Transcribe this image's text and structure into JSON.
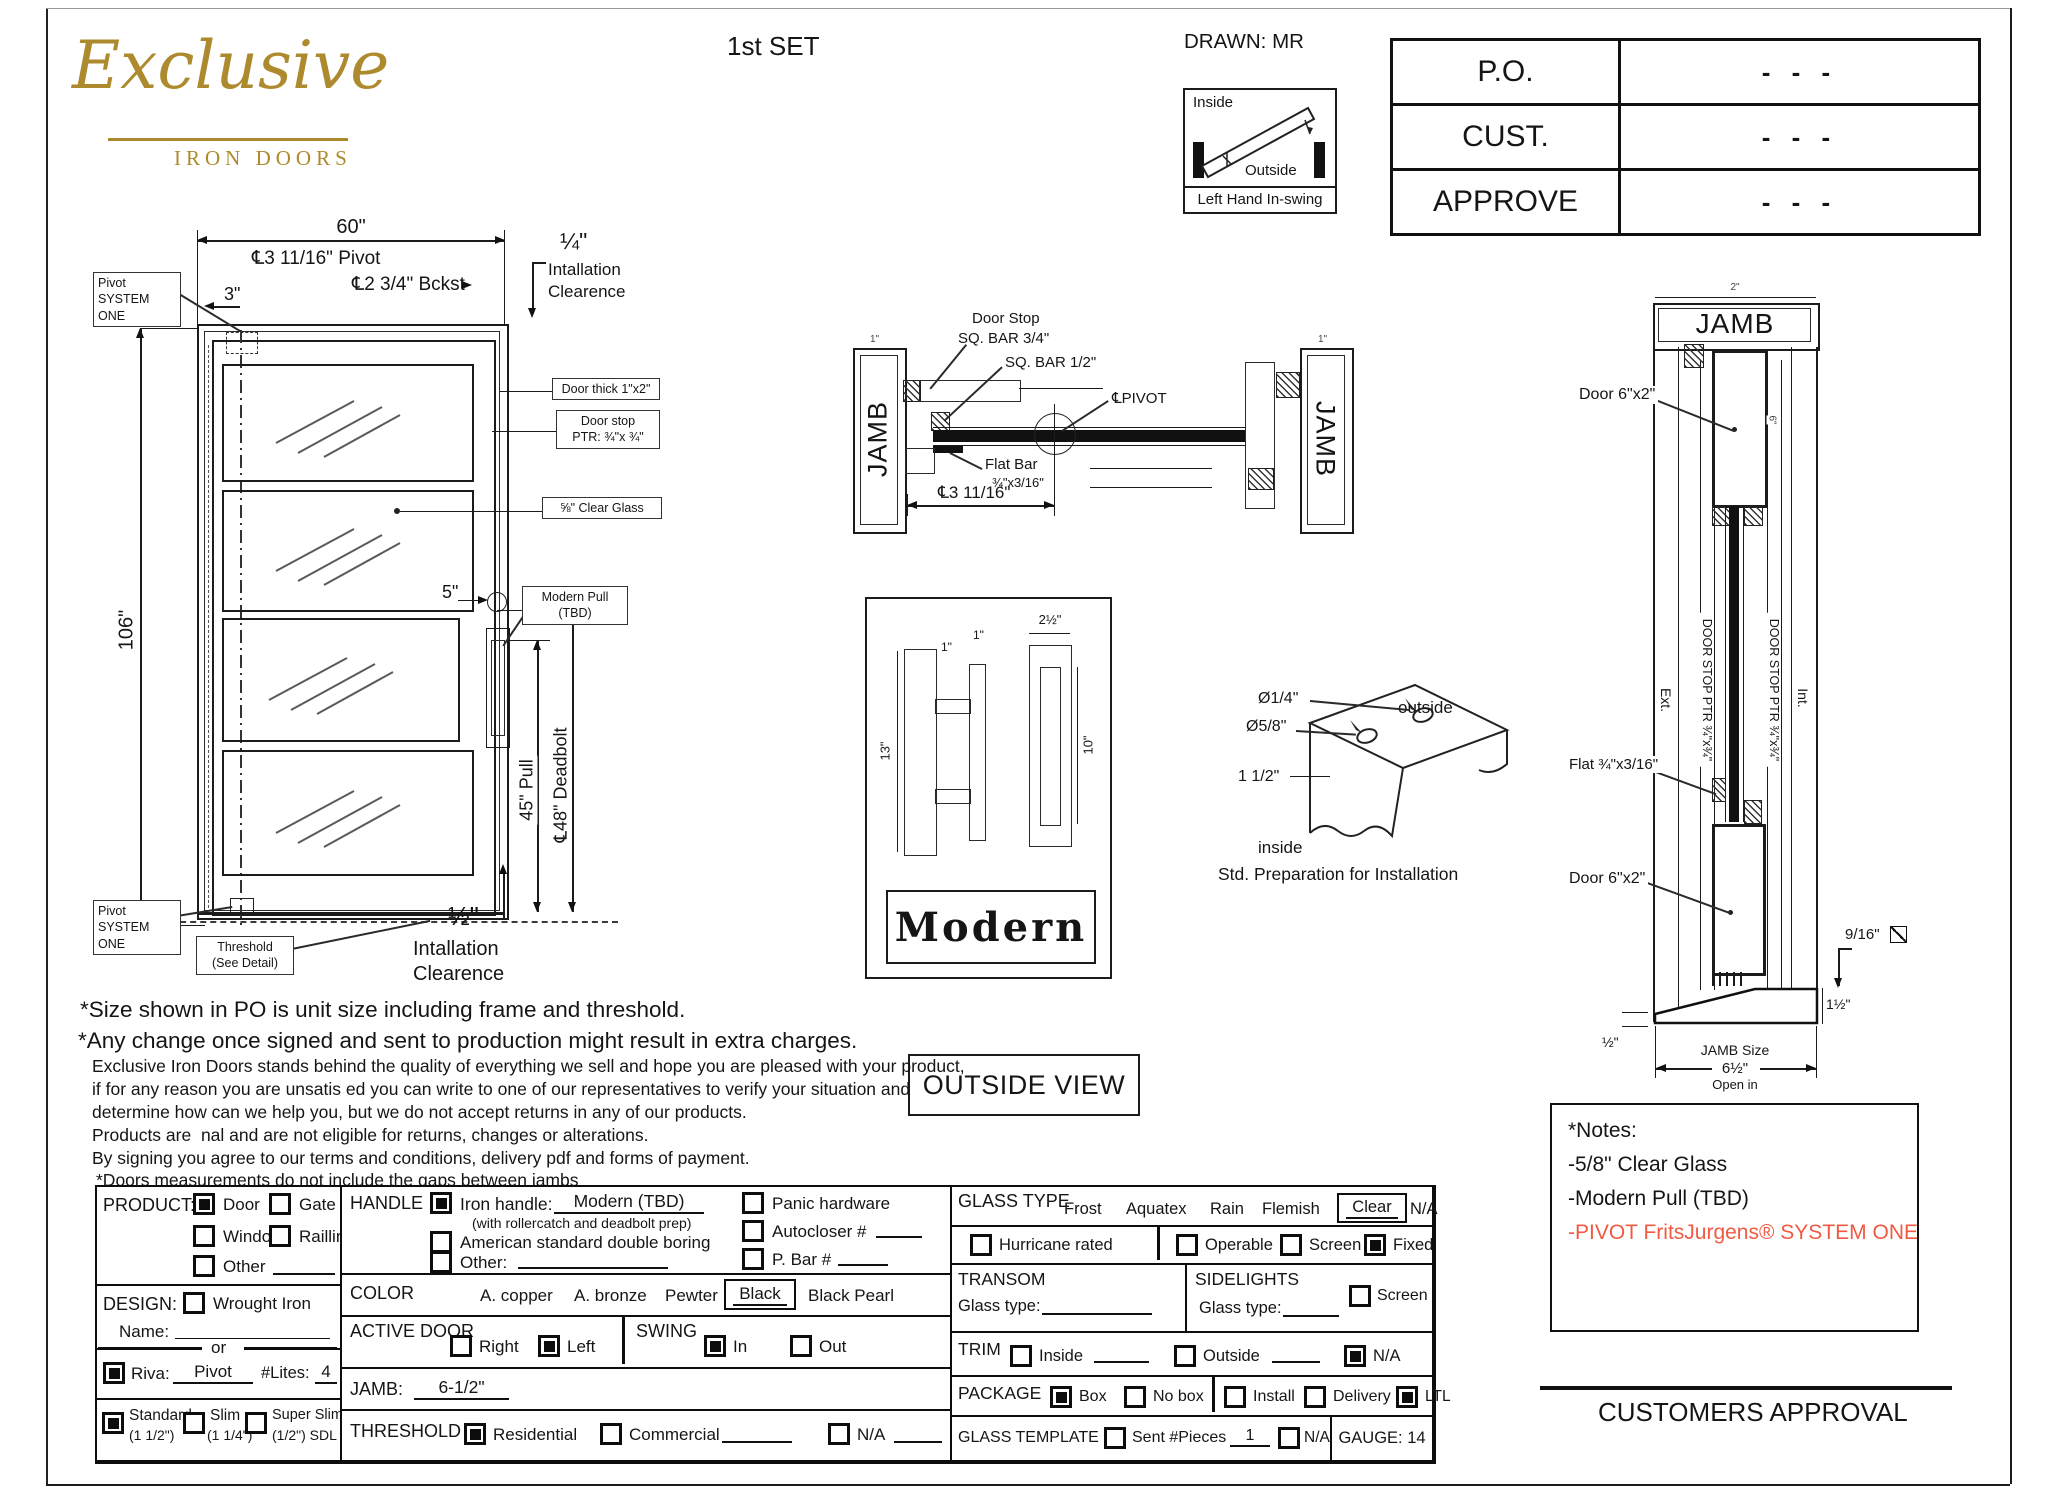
{
  "colors": {
    "gold": "#AD8A2D",
    "accent_orange": "#F05A43",
    "line": "#1C1C1C"
  },
  "header": {
    "set_label": "1st SET",
    "drawn_label": "DRAWN: MR",
    "logo_name": "Exclusive",
    "logo_sub": "IRON DOORS",
    "swing": {
      "inside": "Inside",
      "outside": "Outside",
      "caption": "Left Hand In-swing"
    },
    "approval_table": {
      "rows": [
        {
          "label": "P.O.",
          "value": "- - -"
        },
        {
          "label": "CUST.",
          "value": "- - -"
        },
        {
          "label": "APPROVE",
          "value": "- - -"
        }
      ]
    }
  },
  "elevation": {
    "dim_width": "60\"",
    "dim_height": "106\"",
    "pivot_dim": "℄3 11/16\" Pivot",
    "dim_3": "3\"",
    "backset": "℄2 3/4\" Bckst",
    "clr_top_frac": "¼\"",
    "clr_top_l1": "Intallation",
    "clr_top_l2": "Clearence",
    "pivot_sys_l1": "Pivot",
    "pivot_sys_l2": "SYSTEM ONE",
    "door_thick": "Door thick 1\"x2\"",
    "door_stop_l1": "Door stop",
    "door_stop_l2": "PTR: ¾\"x ¾\"",
    "clear_glass": "⅝\" Clear Glass",
    "dim_5": "5\"",
    "modern_pull_l1": "Modern Pull",
    "modern_pull_l2": "(TBD)",
    "pull_dim": "45\" Pull",
    "deadbolt_dim": "℄48\" Deadbolt",
    "pivot_sys2_l1": "Pivot",
    "pivot_sys2_l2": "SYSTEM ONE",
    "threshold_l1": "Threshold",
    "threshold_l2": "(See Detail)",
    "clr_bot_frac": "½\"",
    "clr_bot_l1": "Intallation",
    "clr_bot_l2": "Clearence"
  },
  "plan": {
    "jamb_left": "JAMB",
    "jamb_right": "JAMB",
    "door_stop_l1": "Door Stop",
    "door_stop_l2": "SQ. BAR 3/4\"",
    "sq_bar": "SQ. BAR 1/2\"",
    "pivot": "℄PIVOT",
    "flat_bar_l1": "Flat Bar",
    "flat_bar_l2": "¾\"x3/16\"",
    "dim": "℄3 11/16\"",
    "dim_1_left": "1\"",
    "dim_1_right": "1\""
  },
  "handle_detail": {
    "dim_13": "13\"",
    "dim_1a": "1\"",
    "dim_1b": "1\"",
    "dim_2h": "2½\"",
    "dim_10": "10\"",
    "name": "Modern"
  },
  "outside_view": "OUTSIDE VIEW",
  "prep": {
    "d1": "Ø1/4\"",
    "d2": "Ø5/8\"",
    "d3": "1 1/2\"",
    "outside": "outside",
    "inside": "inside",
    "caption": "Std. Preparation for Installation"
  },
  "jamb_section": {
    "dim_2": "2\"",
    "title": "JAMB",
    "door_top": "Door 6\"x2\"",
    "dim_6": "6\"",
    "stop_left": "DOOR STOP PTR ¾\"x¾\"",
    "stop_right": "DOOR STOP PTR ¾\"x¾\"",
    "ext": "Ext.",
    "int": "Int.",
    "flat": "Flat ¾\"x3/16\"",
    "door_bottom": "Door 6\"x2\"",
    "dim_916": "9/16\"",
    "dim_1h": "1½\"",
    "dim_h": "½\"",
    "size_l1": "JAMB Size",
    "size_l2": "6½\"",
    "size_l3": "Open in"
  },
  "notes_left": {
    "line1": "*Size shown in PO is unit size including frame and threshold.",
    "line2": "*Any change once signed and sent to production might result in extra charges.",
    "para": [
      "Exclusive Iron Doors stands behind the quality of everything we sell and hope you are pleased with your product,",
      "if for any reason you are unsatis ed you can write to one of our representatives to verify your situation and",
      "determine how can we help you, but we do not accept returns in any of our products.",
      "Products are  nal and are not eligible for returns, changes or alterations.",
      "By signing you agree to our terms and conditions, delivery pdf and forms of payment.",
      "*Doors measurements do not include the gaps between jambs"
    ]
  },
  "form": {
    "product": {
      "label": "PRODUCT:",
      "door": {
        "label": "Door",
        "checked": true
      },
      "gate": {
        "label": "Gate",
        "checked": false
      },
      "window": {
        "label": "Window",
        "checked": false
      },
      "railling": {
        "label": "Railling",
        "checked": false
      },
      "other": {
        "label": "Other",
        "checked": false
      }
    },
    "design": {
      "label": "DESIGN:",
      "wrought": {
        "label": "Wrought Iron",
        "checked": false
      },
      "name_label": "Name:",
      "or_label": "or"
    },
    "riva": {
      "checked": true,
      "label": "Riva:",
      "value": "Pivot",
      "lites_label": "#Lites:",
      "lites_value": "4"
    },
    "profile": {
      "standard": {
        "label": "Standard",
        "sub": "(1 1/2\")",
        "checked": true
      },
      "slim": {
        "label": "Slim",
        "sub": "(1 1/4\")",
        "checked": false
      },
      "super_slim": {
        "label": "Super Slim",
        "sub": "(1/2\") SDL",
        "checked": false
      }
    },
    "handle": {
      "label": "HANDLE",
      "iron": {
        "checked": true,
        "label": "Iron handle:",
        "value": "Modern (TBD)"
      },
      "iron_note": "(with rollercatch and deadbolt prep)",
      "american": {
        "checked": false,
        "label": "American standard double boring"
      },
      "other": {
        "checked": false,
        "label": "Other:"
      },
      "panic": {
        "checked": false,
        "label": "Panic hardware"
      },
      "autocloser": {
        "checked": false,
        "label": "Autocloser #"
      },
      "pbar": {
        "checked": false,
        "label": "P. Bar #"
      }
    },
    "color": {
      "label": "COLOR",
      "opt1": "A. copper",
      "opt2": "A. bronze",
      "opt3": "Pewter",
      "selected": "Black",
      "opt4": "Black Pearl"
    },
    "active_door": {
      "label": "ACTIVE DOOR",
      "right": {
        "label": "Right",
        "checked": false
      },
      "left": {
        "label": "Left",
        "checked": true
      }
    },
    "swing": {
      "label": "SWING",
      "in": {
        "label": "In",
        "checked": true
      },
      "out": {
        "label": "Out",
        "checked": false
      }
    },
    "jamb": {
      "label": "JAMB:",
      "value": "6-1/2\""
    },
    "threshold": {
      "label": "THRESHOLD",
      "residential": {
        "label": "Residential",
        "checked": true
      },
      "commercial": {
        "label": "Commercial",
        "checked": false
      },
      "na": {
        "label": "N/A",
        "checked": false
      }
    },
    "glass_type": {
      "label": "GLASS TYPE",
      "opt1": "Frost",
      "opt2": "Aquatex",
      "opt3": "Rain",
      "opt4": "Flemish",
      "selected": "Clear",
      "na": "N/A"
    },
    "glass_opts": {
      "hurricane": {
        "label": "Hurricane rated",
        "checked": false
      },
      "operable": {
        "label": "Operable",
        "checked": false
      },
      "screen": {
        "label": "Screen",
        "checked": false
      },
      "fixed": {
        "label": "Fixed",
        "checked": true
      }
    },
    "transom": {
      "label": "TRANSOM",
      "glass_label": "Glass type:"
    },
    "sidelights": {
      "label": "SIDELIGHTS",
      "glass_label": "Glass type:",
      "screen": {
        "label": "Screen",
        "checked": false
      }
    },
    "trim": {
      "label": "TRIM",
      "inside": {
        "label": "Inside",
        "checked": false
      },
      "outside": {
        "label": "Outside",
        "checked": false
      },
      "na": {
        "label": "N/A",
        "checked": true
      }
    },
    "package": {
      "label": "PACKAGE",
      "box": {
        "label": "Box",
        "checked": true
      },
      "nobox": {
        "label": "No box",
        "checked": false
      },
      "install": {
        "label": "Install",
        "checked": false
      },
      "delivery": {
        "label": "Delivery",
        "checked": false
      },
      "ltl": {
        "label": "LTL",
        "checked": true
      }
    },
    "glass_template": {
      "label": "GLASS TEMPLATE",
      "sent": {
        "label": "Sent #Pieces",
        "checked": false
      },
      "pieces_value": "1",
      "na": {
        "label": "N/A",
        "checked": false
      },
      "gauge": "GAUGE: 14"
    }
  },
  "notes_box": {
    "title": "*Notes:",
    "item1": "-5/8\" Clear Glass",
    "item2": "-Modern Pull (TBD)",
    "item3": "-PIVOT FritsJurgens® SYSTEM ONE"
  },
  "approval_caption": "CUSTOMERS APPROVAL"
}
